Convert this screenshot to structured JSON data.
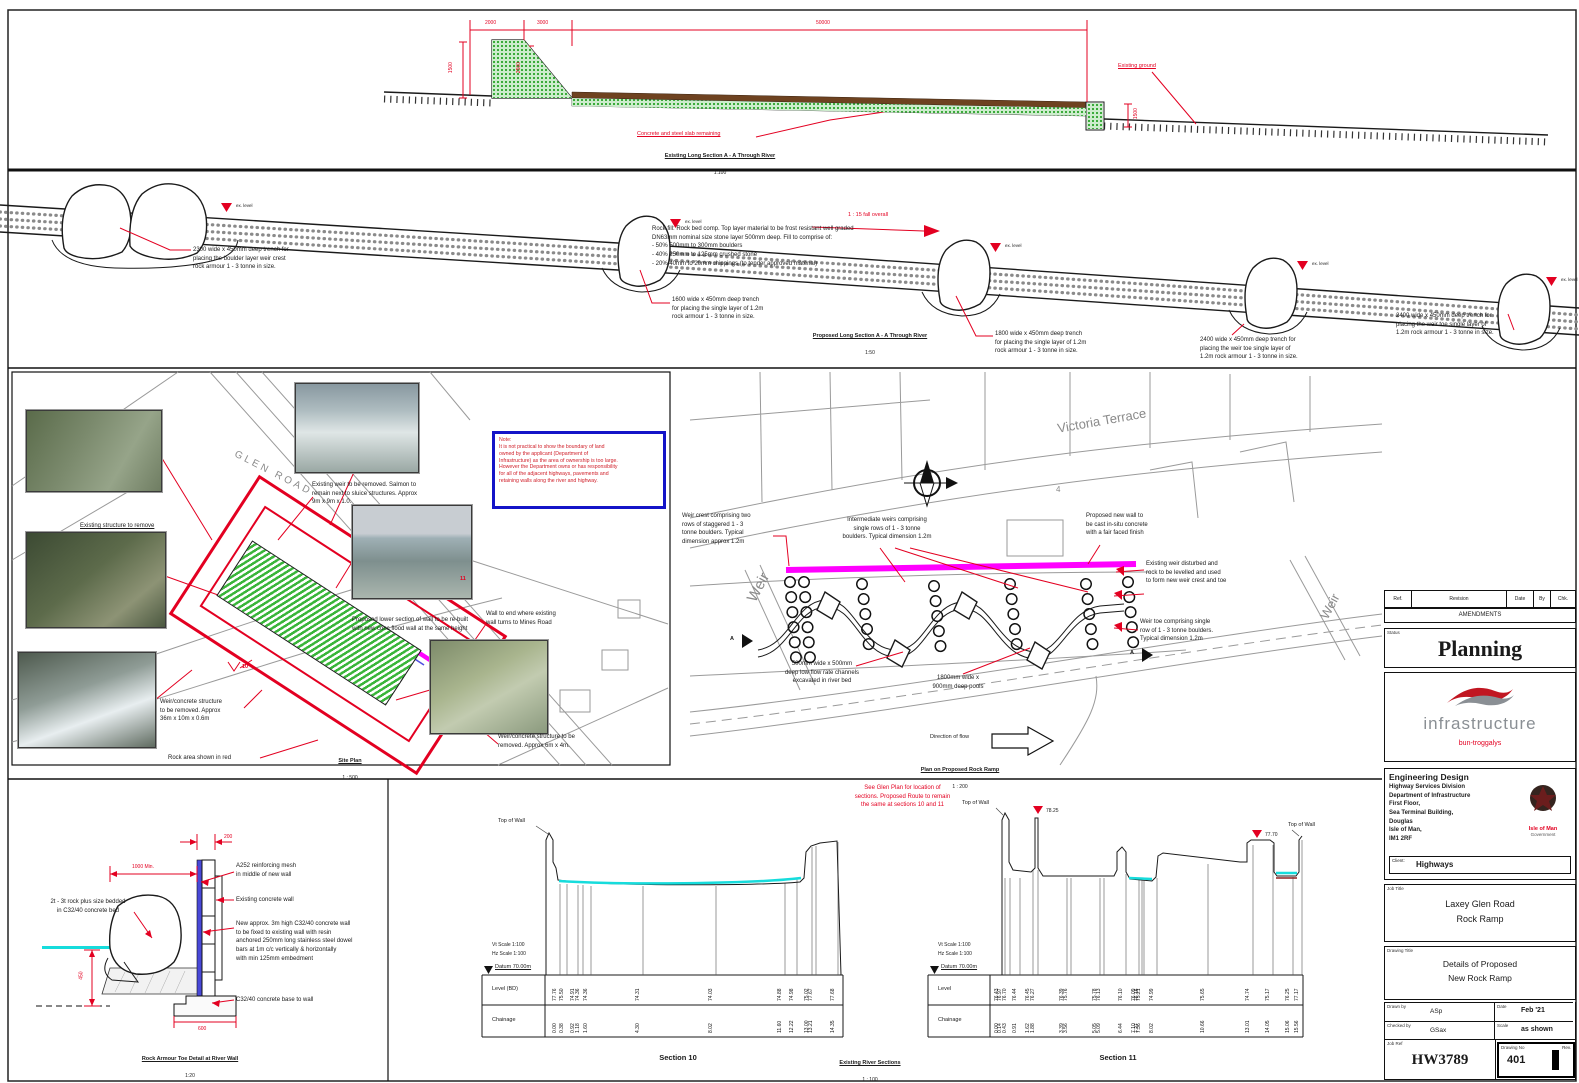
{
  "colors": {
    "accent_red": "#e30021",
    "magenta": "#ff00ff",
    "cyan": "#16dcdc",
    "green": "#2fae2f",
    "note_blue": "#1414c8",
    "slab_brown": "#6e4220"
  },
  "top_section": {
    "title": "Existing Long Section A - A Through River",
    "scale": "1:100",
    "dim_a": "2000",
    "dim_b": "3000",
    "dim_c": "50000",
    "dim_left": "1500",
    "dim_mid": "2500",
    "dim_right": "1500",
    "leader_slab": "Concrete and steel slab remaining",
    "leader_ground": "Existing ground"
  },
  "long_section": {
    "title": "Proposed Long Section A - A Through River",
    "scale": "1:50",
    "fall": "1 : 15 fall overall",
    "level_label": "ex. level",
    "rockfill": "Rock fill: Rock bed comp. Top layer material to be frost resistant well graded\nDN63mm nominal size stone layer 500mm deep. Fill to comprise of:\n- 50% 500mm to 300mm boulders\n- 40% 250mm to 125mm crushed stone\n- 20% 40mm to 20mm chippings (to tender approved material)",
    "ann_b1": "2300 wide x 450mm deep trench for\nplacing the boulder layer weir crest\nrock armour 1 - 3 tonne in size.",
    "ann_b2": "1600 wide x 450mm deep trench\nfor placing the single layer of 1.2m\nrock armour 1 - 3 tonne in size.",
    "ann_b3": "1800 wide x 450mm deep trench\nfor placing the single layer of 1.2m\nrock armour 1 - 3 tonne in size.",
    "ann_b4": "2400 wide x 450mm deep trench for\nplacing the weir toe single layer of\n1.2m rock armour 1 - 3 tonne in size.",
    "ann_b5": "2400 wide x 450mm deep trench for\nplacing the weir toe single layer of\n1.2m rock armour 1 - 3 tonne in size."
  },
  "site_plan": {
    "street": "GLEN ROAD",
    "note": "Note:\nIt is not practical to show the boundary of land\nowned by the applicant (Department of\nInfrastructure) as the area of ownership is too large.\nHowever the Department owns or has responsibility\nfor all of the adjacent highways, pavements and\nretaining walls along the river and highway.",
    "ann1": "Existing weir to be removed. Salmon to\nremain next to sluice structures. Approx\n9m x 9m x 1.0.",
    "ann2": "Existing structure to remove",
    "ann3": "Proposed lower section of wall to be re-built\nwith new conc flood wall at the same height",
    "ann4": "Wall to end where existing\nwall turns to Mines Road",
    "ann5": "Weir/concrete structure\nto be removed. Approx\n36m x 10m x 0.6m",
    "ann6": "Rock area shown in red",
    "ann7": "Weir/concrete structure to be\nremoved. Approx 6m x 4m.",
    "marker10": "10",
    "marker11": "11",
    "title": "Site Plan",
    "scale": "1 : 500"
  },
  "ramp_plan": {
    "street": "Victoria Terrace",
    "parcel": "4",
    "weir": "Weir",
    "section_marker": "A",
    "ann_crest": "Weir crest comprising two\nrows of staggered 1 - 3\ntonne boulders. Typical\ndimension approx 1.2m",
    "ann_mid": "Intermediate weirs comprising\nsingle rows of 1 - 3 tonne\nboulders. Typical dimension 1.2m",
    "ann_wall": "Proposed new wall to\nbe cast in-situ concrete\nwith a fair faced finish",
    "ann_exist": "Existing weir disturbed and\nrock to be levelled and used\nto form new weir crest and toe",
    "ann_toe": "Weir toe comprising single\nrow of 1 - 3 tonne boulders.\nTypical dimension 1.2m",
    "ann_chan": "500mm wide x 500mm\ndeep low flow rate channels\nexcavated in river bed",
    "ann_pools": "1800mm wide x\n900mm deep pools",
    "flow": "Direction of flow",
    "title": "Plan on Proposed Rock Ramp",
    "scale": "1 : 200"
  },
  "toe_detail": {
    "d200": "200",
    "d1000": "1000 Min.",
    "d450": "450",
    "d600": "600",
    "ann_rock": "2t - 3t rock plus size bedded\nin C32/40 concrete bed",
    "ann_mesh": "A252 reinforcing mesh\nin middle of new wall",
    "ann_wall": "Existing concrete wall",
    "ann_new": "New approx. 3m high C32/40 concrete wall\nto be fixed to existing wall with resin\nanchored 250mm long stainless steel dowel\nbars at 1m c/c vertically & horizontally\nwith min 125mm embedment",
    "ann_base": "C32/40 concrete base to wall",
    "title": "Rock Armour Toe Detail at River Wall",
    "scale": "1:20"
  },
  "sections": {
    "note": "See Glen Plan for location of\nsections. Proposed Route to remain\nthe same at sections 10 and 11",
    "existing_title": "Existing River Sections",
    "existing_scale": "1 : 100",
    "s10": {
      "wall": "Top of Wall",
      "vt": "Vt Scale 1:100",
      "hz": "Hz Scale 1:100",
      "datum": "Datum 70.00m",
      "level_label": "Level (BD)",
      "chain_label": "Chainage",
      "title": "Section 10",
      "levels": [
        "77.76",
        "75.50",
        "74.91",
        "74.36",
        "74.36",
        "74.31",
        "74.03",
        "74.88",
        "74.98",
        "75.02",
        "77.67",
        "77.68"
      ],
      "chainages": [
        "0.00",
        "0.38",
        "0.92",
        "1.18",
        "1.60",
        "4.30",
        "8.02",
        "11.60",
        "12.22",
        "13.00",
        "13.21",
        "14.35"
      ]
    },
    "s11": {
      "wall": "Top of Wall",
      "vt": "Vt Scale 1:100",
      "hz": "Hz Scale 1:100",
      "datum": "Datum 70.00m",
      "level_label": "Level",
      "chain_label": "Chainage",
      "title": "Section 11",
      "m_left": "78.25",
      "m_right": "77.70",
      "levels": [
        "76.43",
        "76.97",
        "76.70",
        "76.44",
        "76.45",
        "76.27",
        "76.39",
        "75.76",
        "75.78",
        "76.13",
        "76.10",
        "76.09",
        "76.16",
        "75.21",
        "74.99",
        "75.65",
        "74.74",
        "75.17",
        "76.25",
        "77.17"
      ],
      "chainages": [
        "0.00",
        "0.14",
        "0.43",
        "0.91",
        "1.62",
        "1.88",
        "3.39",
        "3.56",
        "5.05",
        "5.09",
        "6.44",
        "7.10",
        "7.27",
        "7.36",
        "8.02",
        "10.66",
        "13.01",
        "14.05",
        "15.06",
        "15.56"
      ]
    }
  },
  "title_block": {
    "ref": "Ref.",
    "revision": "Revision",
    "date": "Date",
    "by": "By",
    "chk": "Chk.",
    "amendments": "AMENDMENTS",
    "status_label": "Status",
    "status": "Planning",
    "logo_word": "infrastructure",
    "logo_sub": "bun-troggalys",
    "dept_heading": "Engineering Design",
    "dept_address": "Highway Services Division\nDepartment of Infrastructure\nFirst Floor,\nSea Terminal Building,\nDouglas\nIsle of Man,\nIM1 2RF",
    "crest1": "Isle of Man",
    "crest2": "Government",
    "client_label": "Client:",
    "client": "Highways",
    "job_label": "Job Title",
    "job1": "Laxey Glen Road",
    "job2": "Rock Ramp",
    "dwg_label": "Drawing Title",
    "dwg1": "Details of Proposed",
    "dwg2": "New Rock Ramp",
    "drawn_label": "Drawn by",
    "drawn": "ASp",
    "date_label": "Date",
    "date_val": "Feb '21",
    "checked_label": "Checked by",
    "checked": "GSax",
    "scale_label": "Scale",
    "scale_val": "as shown",
    "jobref_label": "Job Ref",
    "jobref": "HW3789",
    "dwgno_label": "Drawing No",
    "dwgno": "401",
    "rev_label": "Rev."
  }
}
